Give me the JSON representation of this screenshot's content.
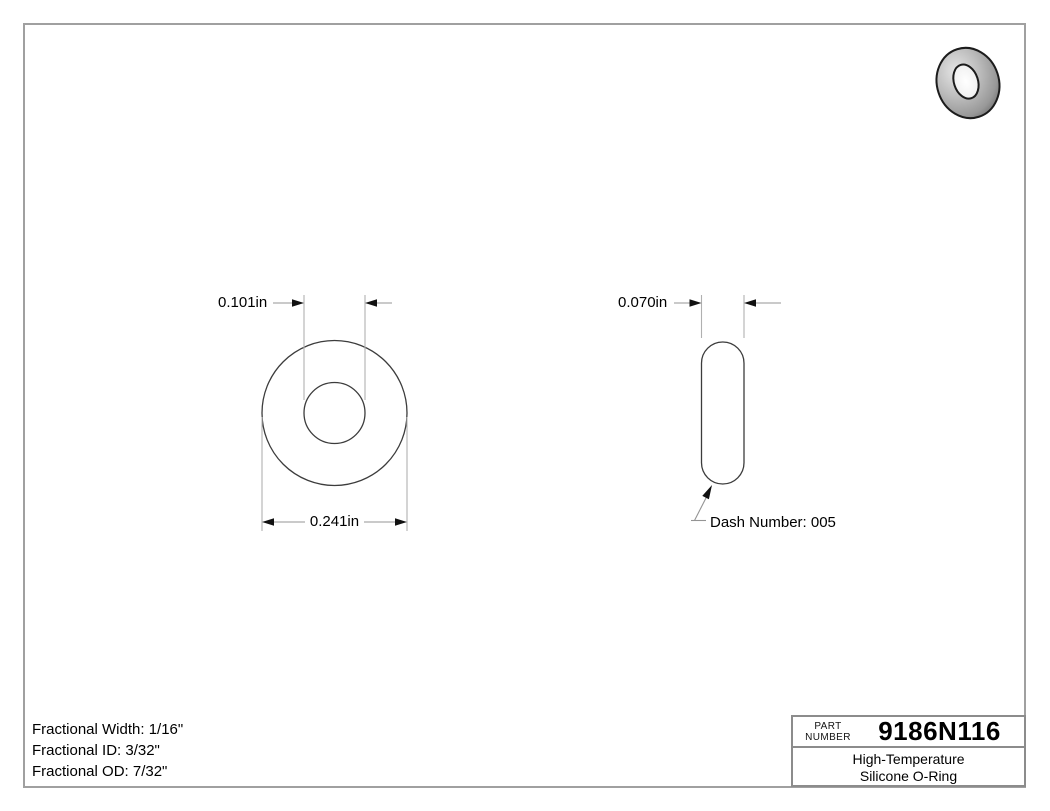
{
  "front_view": {
    "inner_diameter_label": "0.101in",
    "outer_diameter_label": "0.241in"
  },
  "side_view": {
    "width_label": "0.070in",
    "dash_number_label": "Dash Number: 005"
  },
  "specs": {
    "lines": [
      "Fractional Width: 1/16\"",
      "Fractional ID: 3/32\"",
      "Fractional OD: 7/32\""
    ]
  },
  "title_block": {
    "part_label_line1": "PART",
    "part_label_line2": "NUMBER",
    "part_number": "9186N116",
    "description_line1": "High-Temperature",
    "description_line2": "Silicone O-Ring"
  },
  "colors": {
    "drawing_line": "#3c3c3c",
    "dimension_line": "#949494",
    "extension_line": "#b0b0b0",
    "arrowhead": "#111111",
    "page_border": "#a0a0a0",
    "torus_body_gray": "#b3b3b3"
  }
}
